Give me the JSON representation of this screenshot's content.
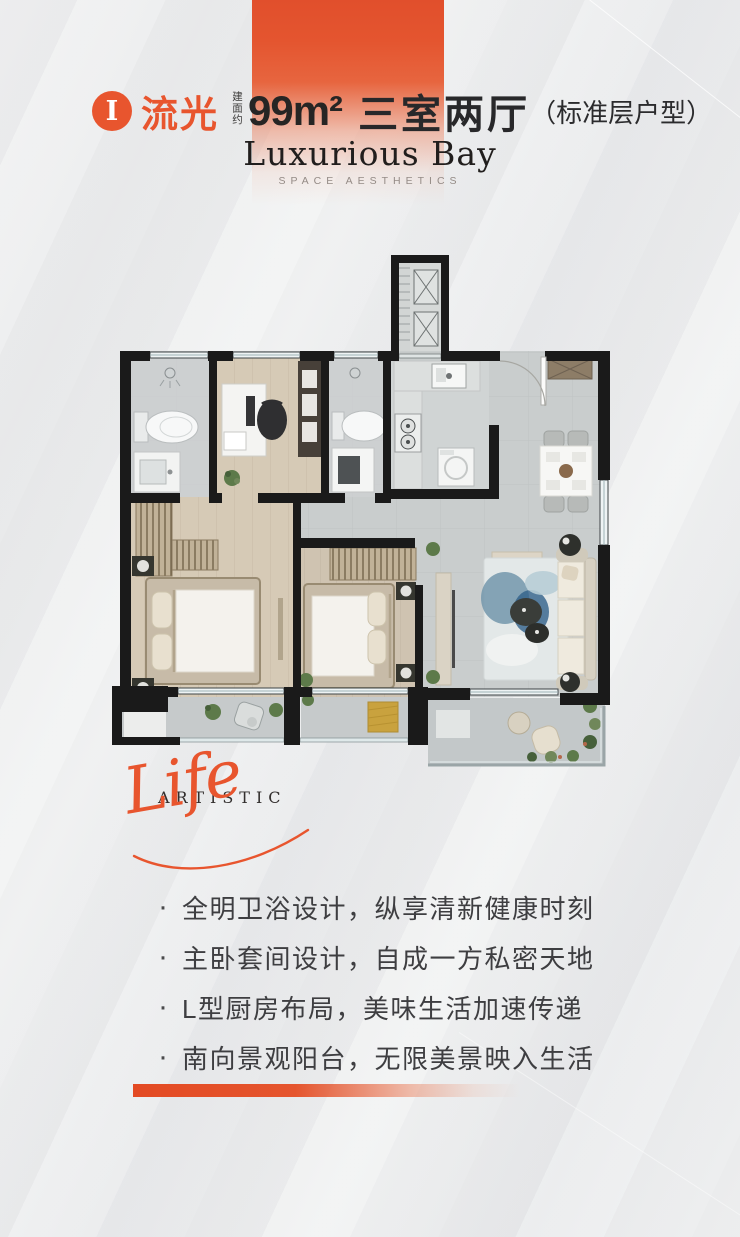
{
  "colors": {
    "accent": "#e8552e",
    "accent-deep": "#e04a26",
    "wall": "#1a1a1a",
    "tile-floor": "#c9cdcd",
    "wood-floor": "#d6cab6",
    "text-dark": "#28282a",
    "text-gray": "#948b86"
  },
  "header": {
    "badge": "I",
    "name": "流光",
    "area_label": "建面约",
    "area_value": "99m²",
    "layout": "三室两厅",
    "note": "（标准层户型）"
  },
  "brand": {
    "name": "Luxurious Bay",
    "tagline": "SPACE AESTHETICS"
  },
  "artistic": {
    "word_caps": "ARTISTIC",
    "word_script": "Life"
  },
  "bullet": "·",
  "features": [
    "全明卫浴设计，纵享清新健康时刻",
    "主卧套间设计，自成一方私密天地",
    "L型厨房布局，美味生活加速传递",
    "南向景观阳台，无限美景映入生活"
  ]
}
